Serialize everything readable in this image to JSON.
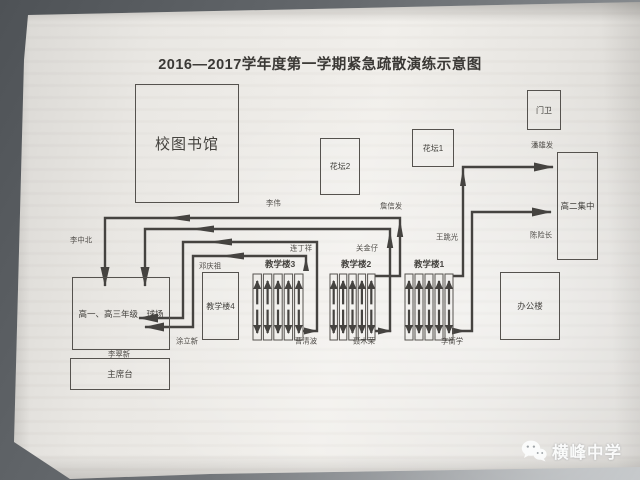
{
  "diagram": {
    "title": "2016—2017学年度第一学期紧急疏散演练示意图",
    "places": {
      "library": "校图书馆",
      "gate_house": "门卫",
      "flower_bed_2": "花坛2",
      "flower_bed_1": "花坛1",
      "grade2_assembly": "高二集中",
      "teaching_building_4": "教学楼4",
      "teaching_building_3": "教学楼3",
      "teaching_building_2": "教学楼2",
      "teaching_building_1": "教学楼1",
      "office_building": "办公楼",
      "playground": "高一、高三年级　球场",
      "rostrum": "主席台"
    },
    "staff_posts": {
      "li_zhongbei": "李中北",
      "li_wei": "李伟",
      "zhan_xinfa": "詹信发",
      "wang_tiaoguang": "王跳光",
      "pan_xiongfa": "潘雄发",
      "chen_xianzhang": "陈险长",
      "lian_dingxiang": "连丁祥",
      "guan_jinzai": "关金仔",
      "deng_qingzu": "邓庆祖",
      "tu_lixin": "涂立新",
      "li_cuixin": "李翠新",
      "cao_qingbo": "曹清波",
      "nie_murong": "聂木荣",
      "li_hengxue": "李衡学"
    },
    "colors": {
      "ink": "#454340",
      "paper": "#eceae6",
      "backdrop": "#6e7276"
    }
  },
  "watermark": {
    "school_name": "横峰中学",
    "icon": "wechat-logo"
  }
}
